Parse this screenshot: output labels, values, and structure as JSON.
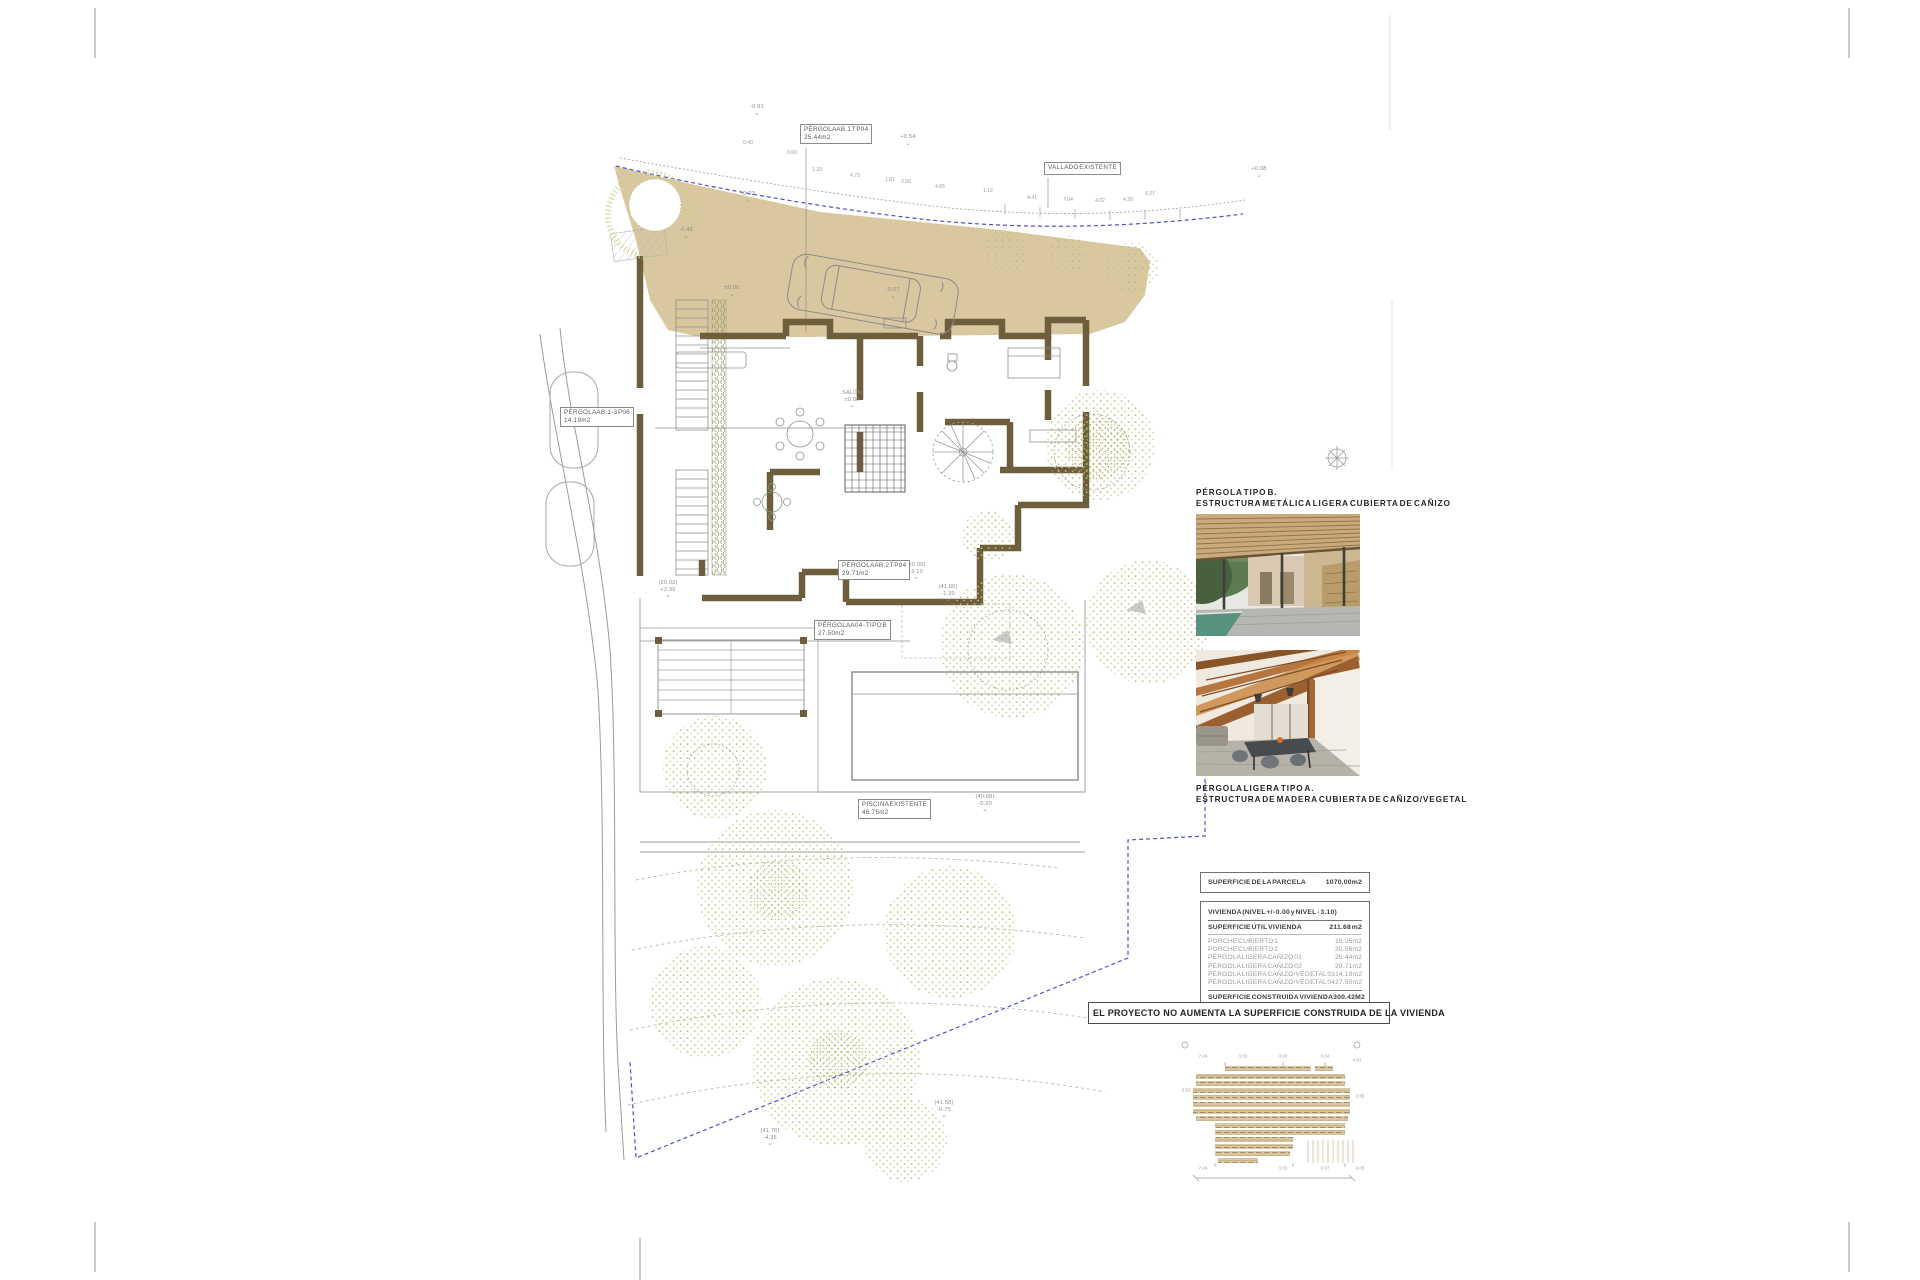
{
  "plan": {
    "boxed_labels": [
      {
        "id": "pergola-ab1",
        "x": 800,
        "y": 124,
        "lines": [
          "PÉRGOLA AB.1 T P04",
          "25.44m2"
        ]
      },
      {
        "id": "vallado-existente",
        "x": 1044,
        "y": 162,
        "lines": [
          "VALLADO EXISTENTE"
        ]
      },
      {
        "id": "pergola-ab3",
        "x": 560,
        "y": 407,
        "lines": [
          "PÉRGOLA AB.1-3 P06",
          "14.19m2"
        ]
      },
      {
        "id": "pergola-ab2",
        "x": 838,
        "y": 560,
        "lines": [
          "PÉRGOLA AB.2 T P04",
          "29.71m2"
        ]
      },
      {
        "id": "pergola-a04",
        "x": 814,
        "y": 620,
        "lines": [
          "PÉRGOLA A04 - TIPO B",
          "27.50m2"
        ]
      },
      {
        "id": "piscina-existente",
        "x": 858,
        "y": 799,
        "lines": [
          "PISCINA EXISTENTE",
          "46.75m2"
        ]
      }
    ],
    "spot_levels": [
      {
        "x": 757,
        "y": 104,
        "lines": [
          "-0.91"
        ]
      },
      {
        "x": 908,
        "y": 134,
        "lines": [
          "+0.54"
        ]
      },
      {
        "x": 1259,
        "y": 166,
        "lines": [
          "+0.08"
        ]
      },
      {
        "x": 748,
        "y": 191,
        "lines": [
          "-0.22"
        ]
      },
      {
        "x": 686,
        "y": 227,
        "lines": [
          "-0.45"
        ]
      },
      {
        "x": 732,
        "y": 285,
        "lines": [
          "±0.00"
        ]
      },
      {
        "x": 893,
        "y": 287,
        "lines": [
          "-0.07"
        ]
      },
      {
        "x": 852,
        "y": 390,
        "lines": [
          "SALÓN",
          "±0.00"
        ]
      },
      {
        "x": 668,
        "y": 580,
        "lines": [
          "(20.02)",
          "+2.30"
        ]
      },
      {
        "x": 916,
        "y": 562,
        "lines": [
          "(±0.00)",
          "-3.10"
        ]
      },
      {
        "x": 948,
        "y": 584,
        "lines": [
          "(41.60)",
          "-1.30"
        ]
      },
      {
        "x": 985,
        "y": 794,
        "lines": [
          "(40.08)",
          "-0.20"
        ]
      },
      {
        "x": 944,
        "y": 1100,
        "lines": [
          "(41.58)",
          "-0.75"
        ]
      },
      {
        "x": 770,
        "y": 1128,
        "lines": [
          "(41.76)",
          "-4.35"
        ]
      }
    ],
    "tiny_dims": [
      {
        "x": 748,
        "y": 143,
        "t": "0.40"
      },
      {
        "x": 792,
        "y": 153,
        "t": "0.60"
      },
      {
        "x": 817,
        "y": 170,
        "t": "1.33"
      },
      {
        "x": 855,
        "y": 176,
        "t": "4.73"
      },
      {
        "x": 890,
        "y": 180,
        "t": "1.81"
      },
      {
        "x": 906,
        "y": 182,
        "t": "2.06"
      },
      {
        "x": 940,
        "y": 187,
        "t": "4.65"
      },
      {
        "x": 988,
        "y": 191,
        "t": "1.12"
      },
      {
        "x": 1032,
        "y": 198,
        "t": "4.41"
      },
      {
        "x": 1068,
        "y": 200,
        "t": "7.04"
      },
      {
        "x": 1100,
        "y": 201,
        "t": "4.02"
      },
      {
        "x": 1128,
        "y": 200,
        "t": "4.28"
      },
      {
        "x": 1150,
        "y": 194,
        "t": "6.27"
      }
    ],
    "roof_dims": [
      {
        "x": 1203,
        "y": 1056,
        "t": "7.04"
      },
      {
        "x": 1243,
        "y": 1056,
        "t": "3.01"
      },
      {
        "x": 1283,
        "y": 1056,
        "t": "4.03"
      },
      {
        "x": 1325,
        "y": 1056,
        "t": "3.04"
      },
      {
        "x": 1357,
        "y": 1060,
        "t": "4.01"
      },
      {
        "x": 1186,
        "y": 1090,
        "t": "3.52"
      },
      {
        "x": 1360,
        "y": 1096,
        "t": "3.55"
      },
      {
        "x": 1203,
        "y": 1168,
        "t": "7.04"
      },
      {
        "x": 1283,
        "y": 1168,
        "t": "3.01"
      },
      {
        "x": 1325,
        "y": 1168,
        "t": "3.07"
      },
      {
        "x": 1360,
        "y": 1168,
        "t": "4.05"
      }
    ]
  },
  "right_column": {
    "photo1_caption": [
      "PÉRGOLA TIPO B.",
      "ESTRUCTURA METÁLICA LIGERA CUBIERTA DE CAÑIZO"
    ],
    "photo2_caption": [
      "PÉRGOLA LIGERA TIPO A.",
      "ESTRUCTURA DE MADERA CUBIERTA DE CAÑIZO/VEGETAL"
    ]
  },
  "areas_table": {
    "parcel_row": {
      "label": "SUPERFICIE DE LA PARCELA",
      "value": "1070.00m2"
    },
    "vivienda_header": "VIVIENDA (NIVEL +/- 0.00 y NIVEL - 3.10)",
    "util_row": {
      "label": "SUPERFICIE ÚTIL VIVIENDA",
      "value": "211.68 m2"
    },
    "rows": [
      {
        "label": "PORCHE CUBIERTO 1",
        "value": "15.25m2"
      },
      {
        "label": "PORCHE CUBIERTO 2",
        "value": "20.56m2"
      },
      {
        "label": "PÉRGOLA LIGERA CAÑIZO 01",
        "value": "25.44m2"
      },
      {
        "label": "PÉRGOLA LIGERA CAÑIZO 02",
        "value": "29.71m2"
      },
      {
        "label": "PÉRGOLA LIGERA CAÑIZO/VEGETAL 03",
        "value": "14.19m2"
      },
      {
        "label": "PÉRGOLA LIGERA CAÑIZO/VEGETAL 04",
        "value": "27.50m2"
      }
    ],
    "construida_row": {
      "label": "SUPERFICIE CONSTRUIDA VIVIENDA",
      "value": "300.42M2"
    }
  },
  "banner": {
    "text": "EL PROYECTO NO AUMENTA LA SUPERFICIE CONSTRUIDA DE LA VIVIENDA"
  },
  "colors": {
    "terrace_tan": "#d9c7a0",
    "wall_brown": "#6d5f3b",
    "boundary_blue": "#4d4fd0",
    "vegetation": "#c9cd86",
    "roof_strip": "#d8c6a0",
    "line_grey": "#999999"
  }
}
